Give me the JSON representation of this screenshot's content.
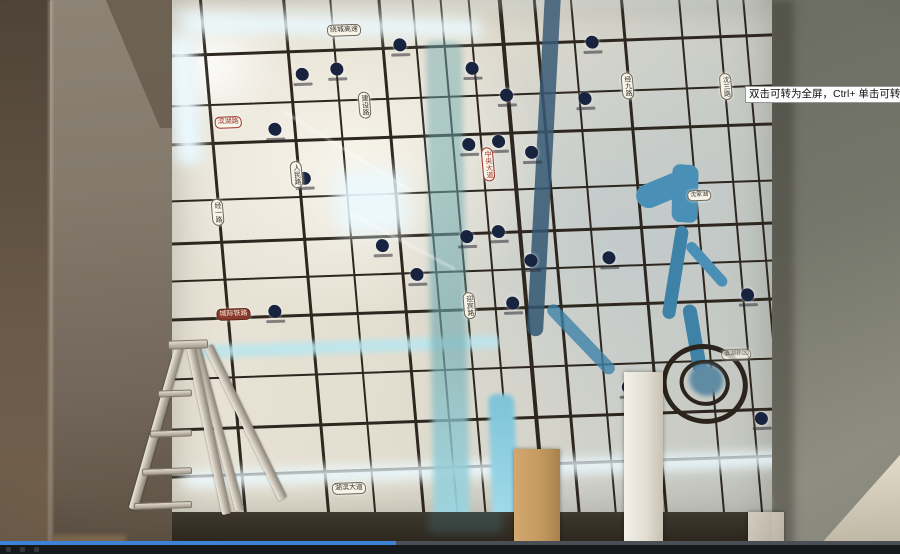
{
  "player": {
    "tooltip": "双击可转为全屏，Ctrl+ 单击可转为",
    "progress_percent": 44
  },
  "scene": {
    "map_labels": [
      {
        "text": "绕城高速"
      },
      {
        "text": "滨湖路"
      },
      {
        "text": "城际铁路"
      },
      {
        "text": "湖滨大道"
      },
      {
        "text": "沈家湖"
      },
      {
        "text": "经一路"
      },
      {
        "text": "人民路"
      },
      {
        "text": "建设路"
      },
      {
        "text": "迎宾路"
      },
      {
        "text": "中央大道"
      },
      {
        "text": "经九路"
      },
      {
        "text": "沈三路"
      },
      {
        "text": "滨湖新区"
      }
    ]
  }
}
